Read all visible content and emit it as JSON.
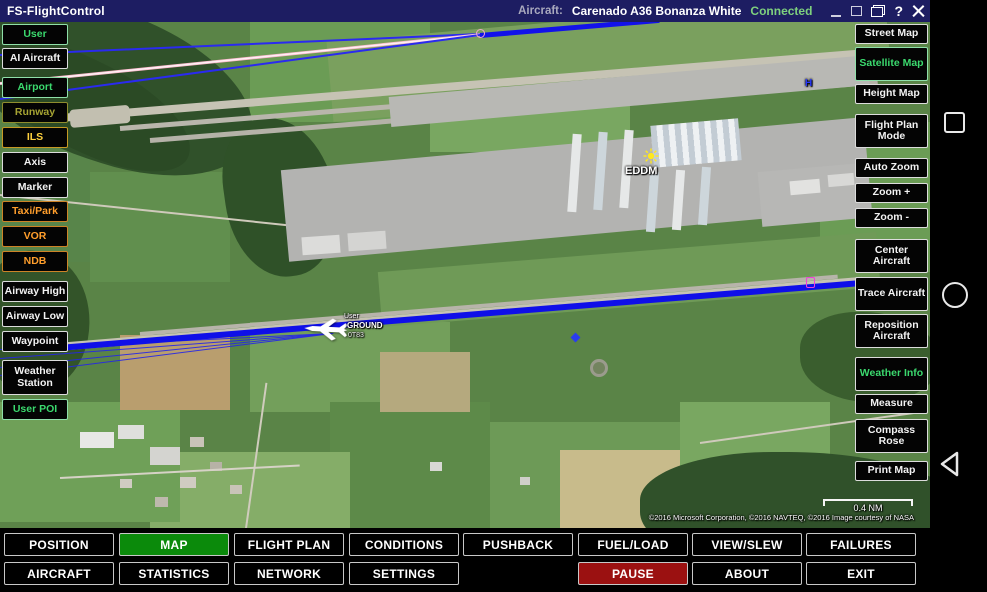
{
  "titlebar": {
    "app_title": "FS-FlightControl",
    "aircraft_label": "Aircraft:",
    "aircraft_name": "Carenado A36 Bonanza White",
    "connection_status": "Connected",
    "help_label": "?"
  },
  "left_sidebar": {
    "items": [
      {
        "label": "User",
        "style": "green"
      },
      {
        "label": "AI Aircraft",
        "style": "white"
      },
      {
        "label": "Airport",
        "style": "green"
      },
      {
        "label": "Runway",
        "style": "olive"
      },
      {
        "label": "ILS",
        "style": "yellow"
      },
      {
        "label": "Axis",
        "style": "white"
      },
      {
        "label": "Marker",
        "style": "white"
      },
      {
        "label": "Taxi/Park",
        "style": "orange"
      },
      {
        "label": "VOR",
        "style": "orange"
      },
      {
        "label": "NDB",
        "style": "orange"
      },
      {
        "label": "Airway High",
        "style": "white"
      },
      {
        "label": "Airway Low",
        "style": "white"
      },
      {
        "label": "Waypoint",
        "style": "white"
      },
      {
        "label": "Weather Station",
        "style": "white"
      },
      {
        "label": "User POI",
        "style": "green"
      }
    ]
  },
  "right_sidebar": {
    "items": [
      {
        "label": "Street Map",
        "style": "white"
      },
      {
        "label": "Satellite Map",
        "style": "green",
        "active": true
      },
      {
        "label": "Height Map",
        "style": "white"
      },
      {
        "label": "Flight Plan Mode",
        "style": "white"
      },
      {
        "label": "Auto Zoom",
        "style": "white"
      },
      {
        "label": "Zoom +",
        "style": "white"
      },
      {
        "label": "Zoom -",
        "style": "white"
      },
      {
        "label": "Center Aircraft",
        "style": "white"
      },
      {
        "label": "Trace Aircraft",
        "style": "white"
      },
      {
        "label": "Reposition Aircraft",
        "style": "white"
      },
      {
        "label": "Weather Info",
        "style": "greenw"
      },
      {
        "label": "Measure",
        "style": "white"
      },
      {
        "label": "Compass Rose",
        "style": "white"
      },
      {
        "label": "Print Map",
        "style": "white"
      }
    ]
  },
  "bottom_bar": {
    "row1": [
      "POSITION",
      "MAP",
      "FLIGHT PLAN",
      "CONDITIONS",
      "PUSHBACK",
      "FUEL/LOAD",
      "VIEW/SLEW",
      "FAILURES"
    ],
    "row2": [
      "AIRCRAFT",
      "STATISTICS",
      "NETWORK",
      "SETTINGS",
      "PAUSE",
      "ABOUT",
      "EXIT"
    ],
    "active_tab": "MAP"
  },
  "map": {
    "airport_code": "EDDM",
    "aircraft_tag": {
      "line1": "User",
      "line2": "GROUND",
      "line3": "0T83"
    },
    "heliport_marker": "H",
    "scale_label": "0.4 NM",
    "copyright": "©2016 Microsoft Corporation, ©2016 NAVTEQ, ©2016 Image courtesy of NASA"
  },
  "colors": {
    "titlebar_bg": "#1d1d62",
    "status_connected": "#7ed07e",
    "tab_active_bg": "#0b8a0b",
    "pause_bg": "#9b1111",
    "button_green": "#3bd96e",
    "button_orange": "#ff9e2c",
    "button_olive": "#a6a433",
    "button_yellow": "#ffd23f",
    "runway_highlight": "#1010e8",
    "ils_centerline_pink": "#f5a8c5"
  }
}
